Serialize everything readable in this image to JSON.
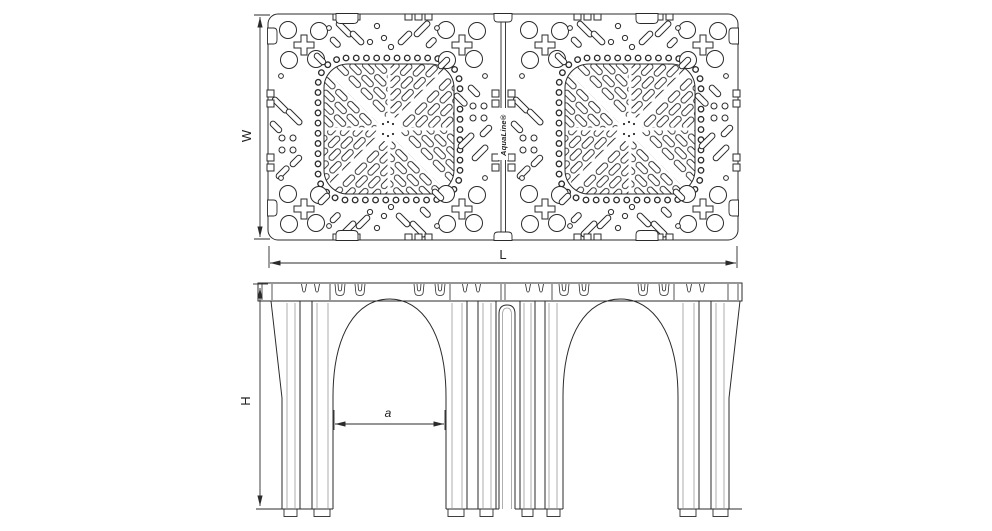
{
  "drawing": {
    "logo_text": "AquaLine®",
    "labels": {
      "width": "W",
      "length": "L",
      "height": "H",
      "arch_span": "a"
    },
    "colors": {
      "line": "#2b2b2b",
      "light_line": "#9a9a9a",
      "background": "#ffffff"
    }
  }
}
